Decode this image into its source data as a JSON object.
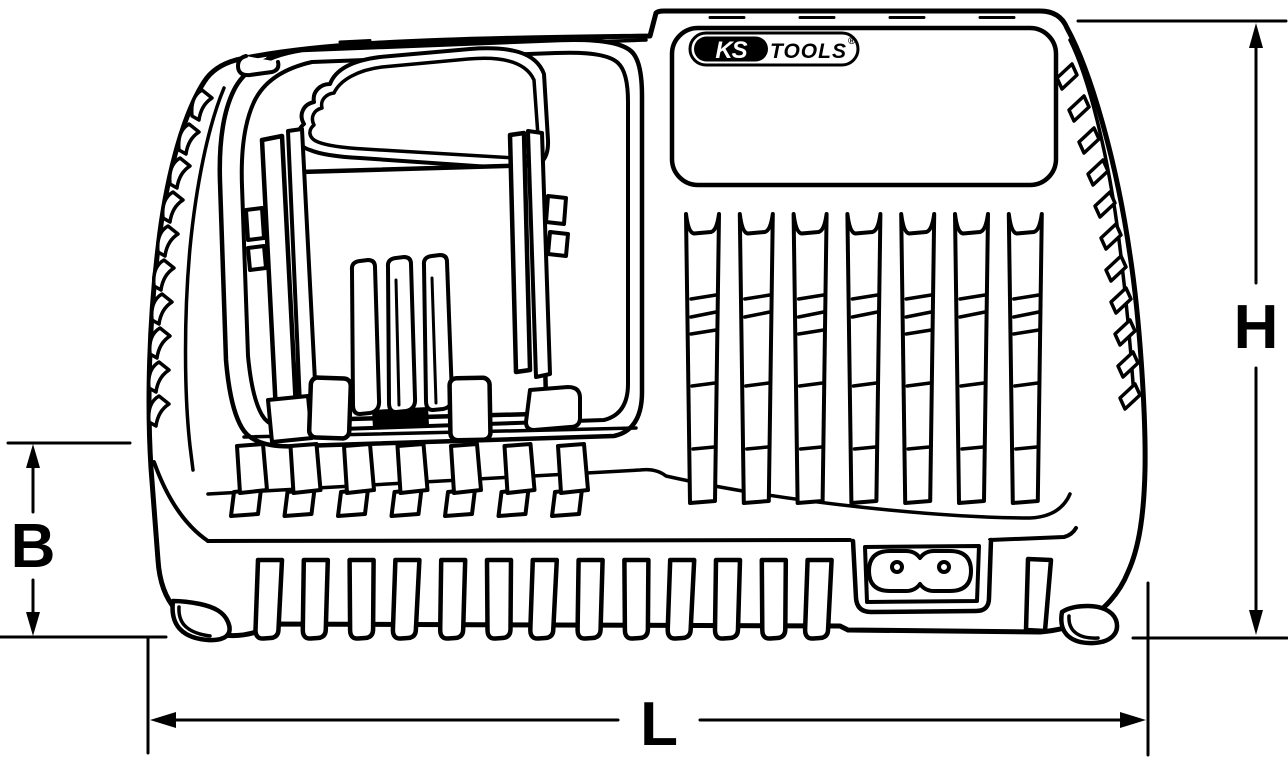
{
  "title": "Battery charger dimensional drawing",
  "brand": {
    "name_left": "KS",
    "name_right": "TOOLS",
    "registered_mark": "®"
  },
  "dimensions": {
    "depth_label": "B",
    "height_label": "H",
    "length_label": "L"
  },
  "diagram": {
    "type": "technical-line-drawing",
    "subject": "KS Tools battery charger, front elevation with dimension arrows",
    "line_color": "#000000",
    "background_color": "#ffffff",
    "power_inlet": "C8 two-pin socket",
    "counts": {
      "top_vent_slots": 7,
      "deck_ribs": 7,
      "front_fins": 13,
      "left_grip_marks": 10,
      "right_grip_marks": 11,
      "top_edge_ticks": 8,
      "feet": 2
    }
  }
}
